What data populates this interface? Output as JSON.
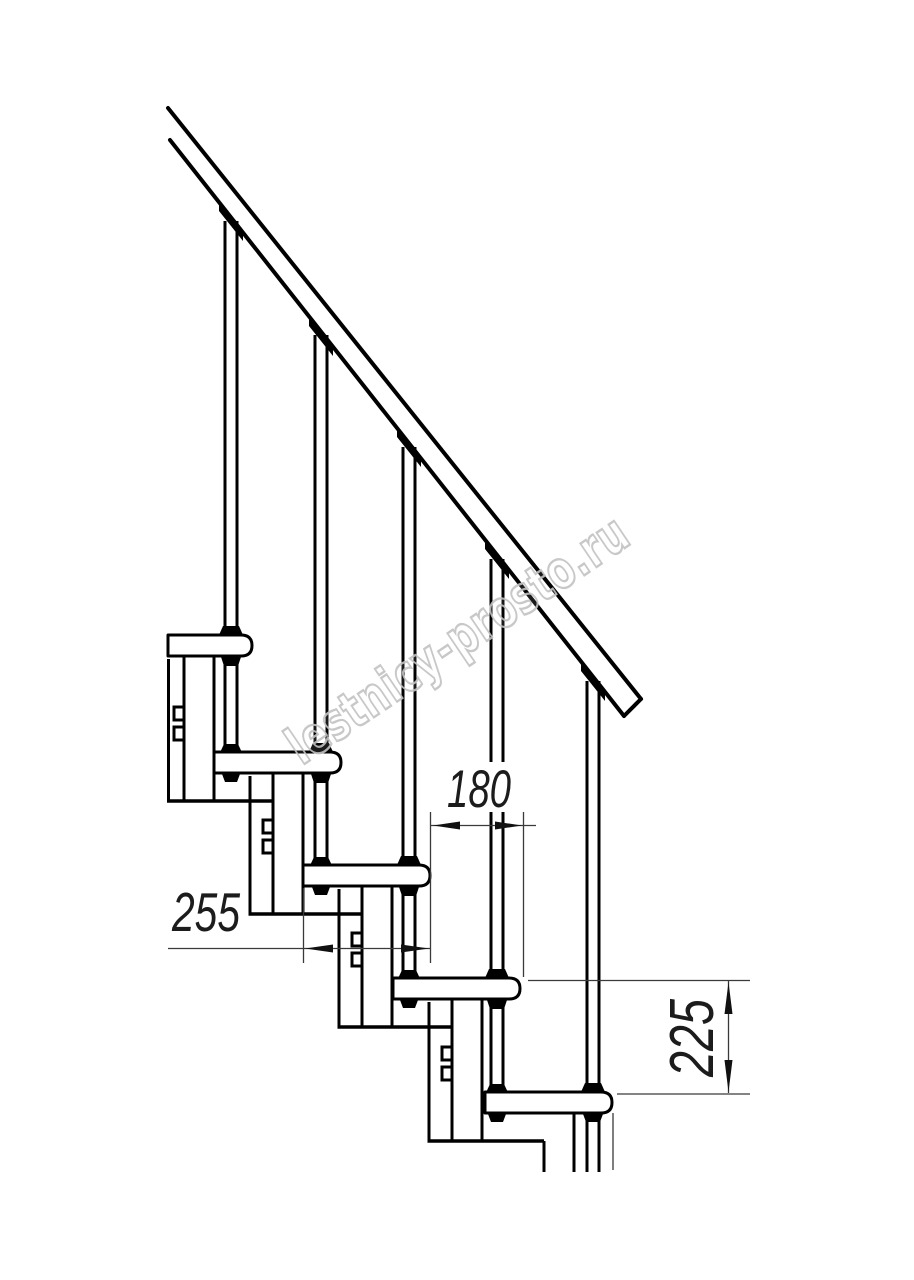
{
  "figure": {
    "type": "technical-line-drawing",
    "subject": "modular staircase side elevation with handrail and balusters",
    "tread_count": 5,
    "baluster_count": 5
  },
  "dimensions": {
    "tread_depth": {
      "value": "255",
      "orientation": "horizontal"
    },
    "step_run": {
      "value": "180",
      "orientation": "horizontal"
    },
    "step_rise": {
      "value": "225",
      "orientation": "vertical"
    }
  },
  "watermark": {
    "text": "lestnicy-prosto.ru",
    "color": "#c3c3c3"
  },
  "colors": {
    "outline": "#000000",
    "dimension_line": "#3a3a3a",
    "background": "#ffffff"
  }
}
